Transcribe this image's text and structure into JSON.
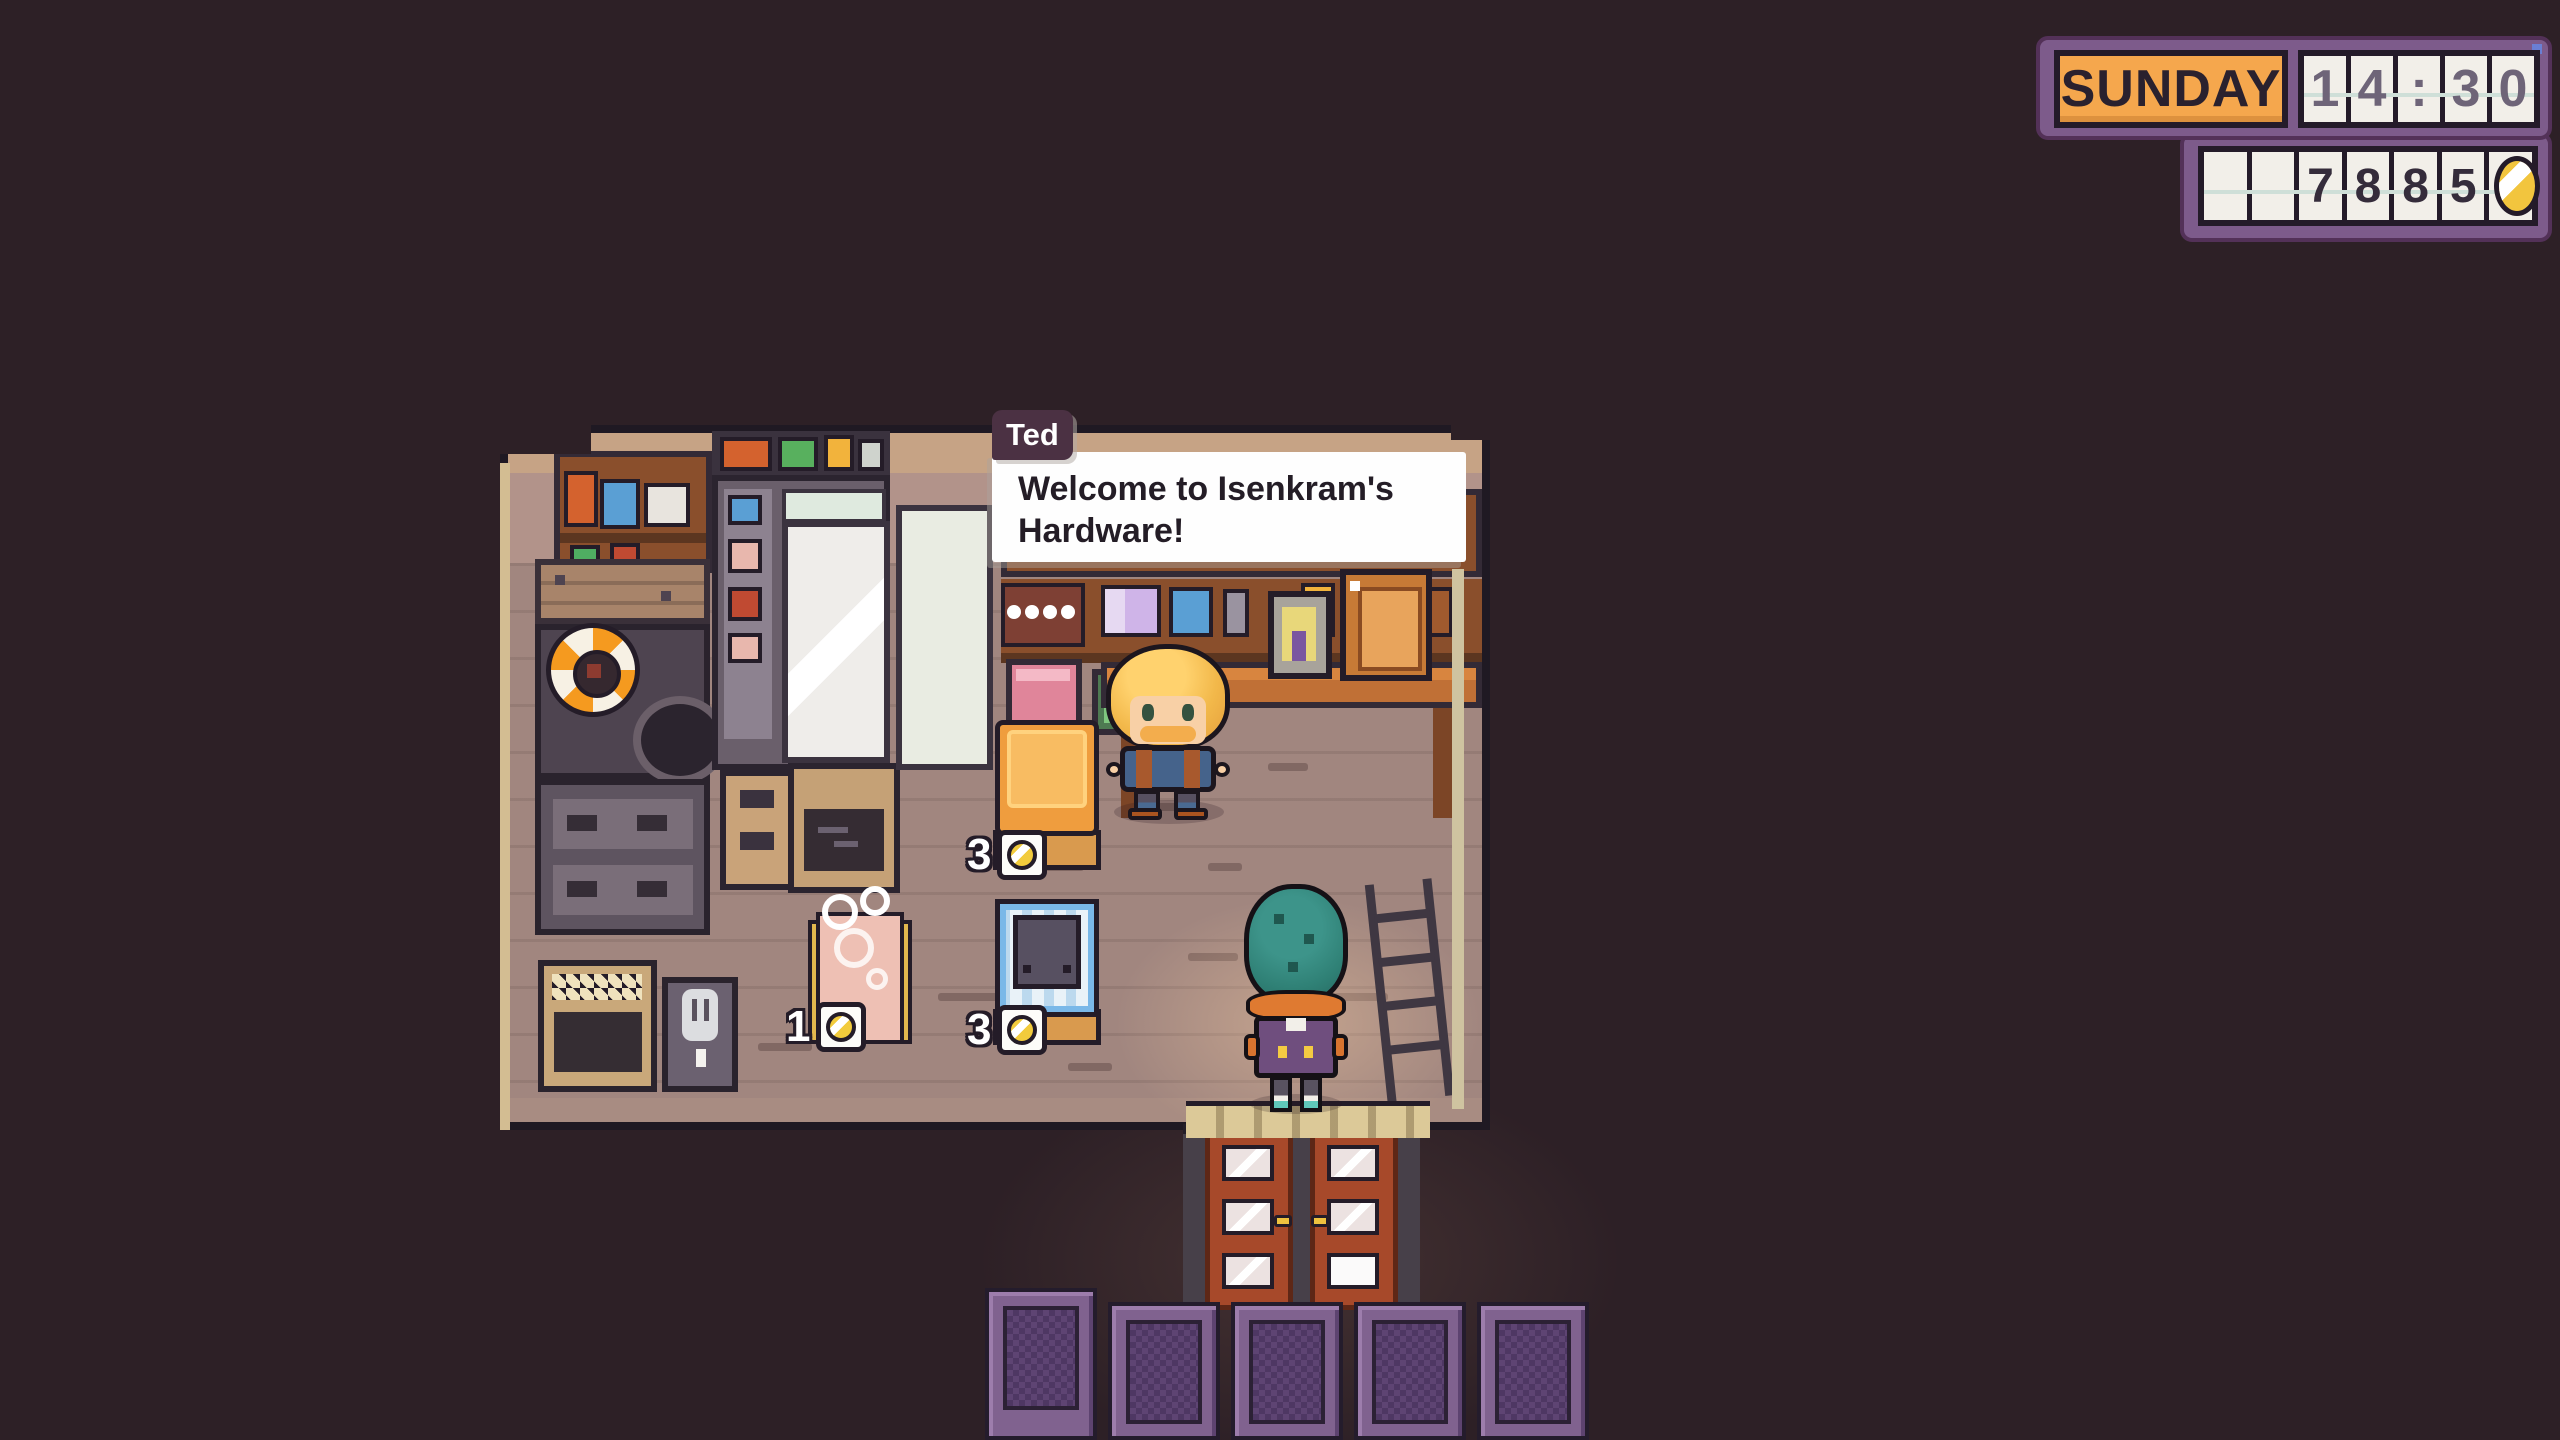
{
  "hud": {
    "day": "SUNDAY",
    "time": "14:30",
    "time_cells": [
      "1",
      "4",
      ":",
      "3",
      "0"
    ],
    "money": "7885",
    "money_cells": [
      "",
      "",
      "7",
      "8",
      "8",
      "5"
    ],
    "currency_icon": "gold-coin"
  },
  "dialogue": {
    "speaker": "Ted",
    "text": "Welcome to Isenkram's Hardware!"
  },
  "shop": {
    "items_for_sale": [
      {
        "name": "orange-display-machine",
        "price": "3",
        "currency_icon": "gold-coin"
      },
      {
        "name": "pink-bathtub",
        "price": "1",
        "currency_icon": "gold-coin"
      },
      {
        "name": "blue-washer-crate",
        "price": "3",
        "currency_icon": "gold-coin"
      }
    ]
  },
  "colors": {
    "background": "#2d2026",
    "hud_frame_purple": "#7d5b8b",
    "hud_day_orange": "#f5a74d",
    "coin_gold": "#f2c53e",
    "dialogue_tag_plum": "#4b3143",
    "floor_mauve": "#a1867f",
    "door_red": "#a7492a",
    "fence_purple": "#80628f"
  }
}
